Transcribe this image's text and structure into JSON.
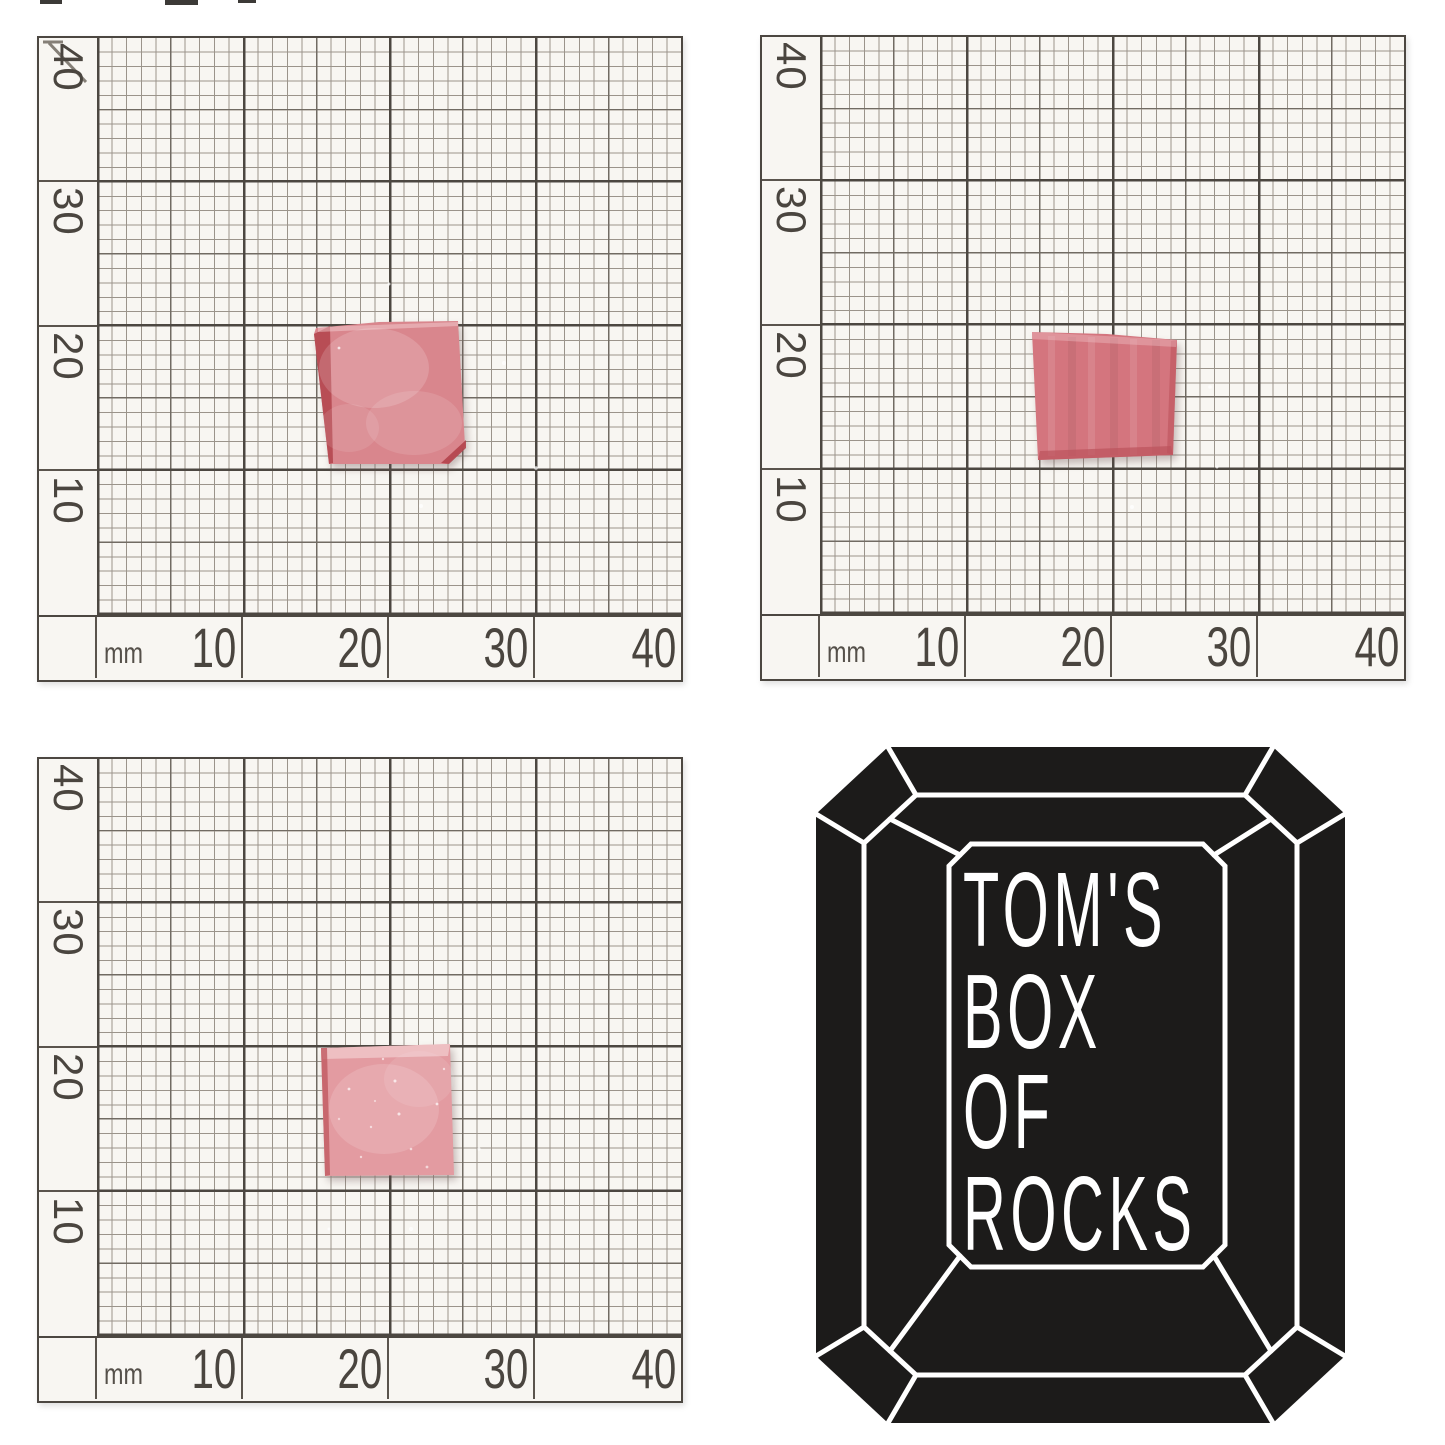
{
  "page": {
    "background": "#ffffff",
    "paper_color": "#f8f6f2"
  },
  "ruler": {
    "unit_label": "mm",
    "x_ticks": [
      "10",
      "20",
      "30",
      "40"
    ],
    "y_ticks": [
      "40",
      "30",
      "20",
      "10"
    ]
  },
  "stones": {
    "top_left": {
      "fill": "#d9868d",
      "edge": "#b2434b",
      "highlight": "#f6d8da"
    },
    "top_right": {
      "fill": "#d4757e",
      "edge": "#bc525c",
      "highlight": "#f0c3c7"
    },
    "bottom_left": {
      "fill": "#e39ba1",
      "edge": "#c05a62",
      "highlight": "#f8dcde"
    }
  },
  "logo": {
    "lines": [
      "TOM'S",
      "BOX",
      "OF",
      "ROCKS"
    ],
    "gem_color": "#1c1b1a",
    "line_color": "#ffffff",
    "text_color": "#ffffff"
  }
}
